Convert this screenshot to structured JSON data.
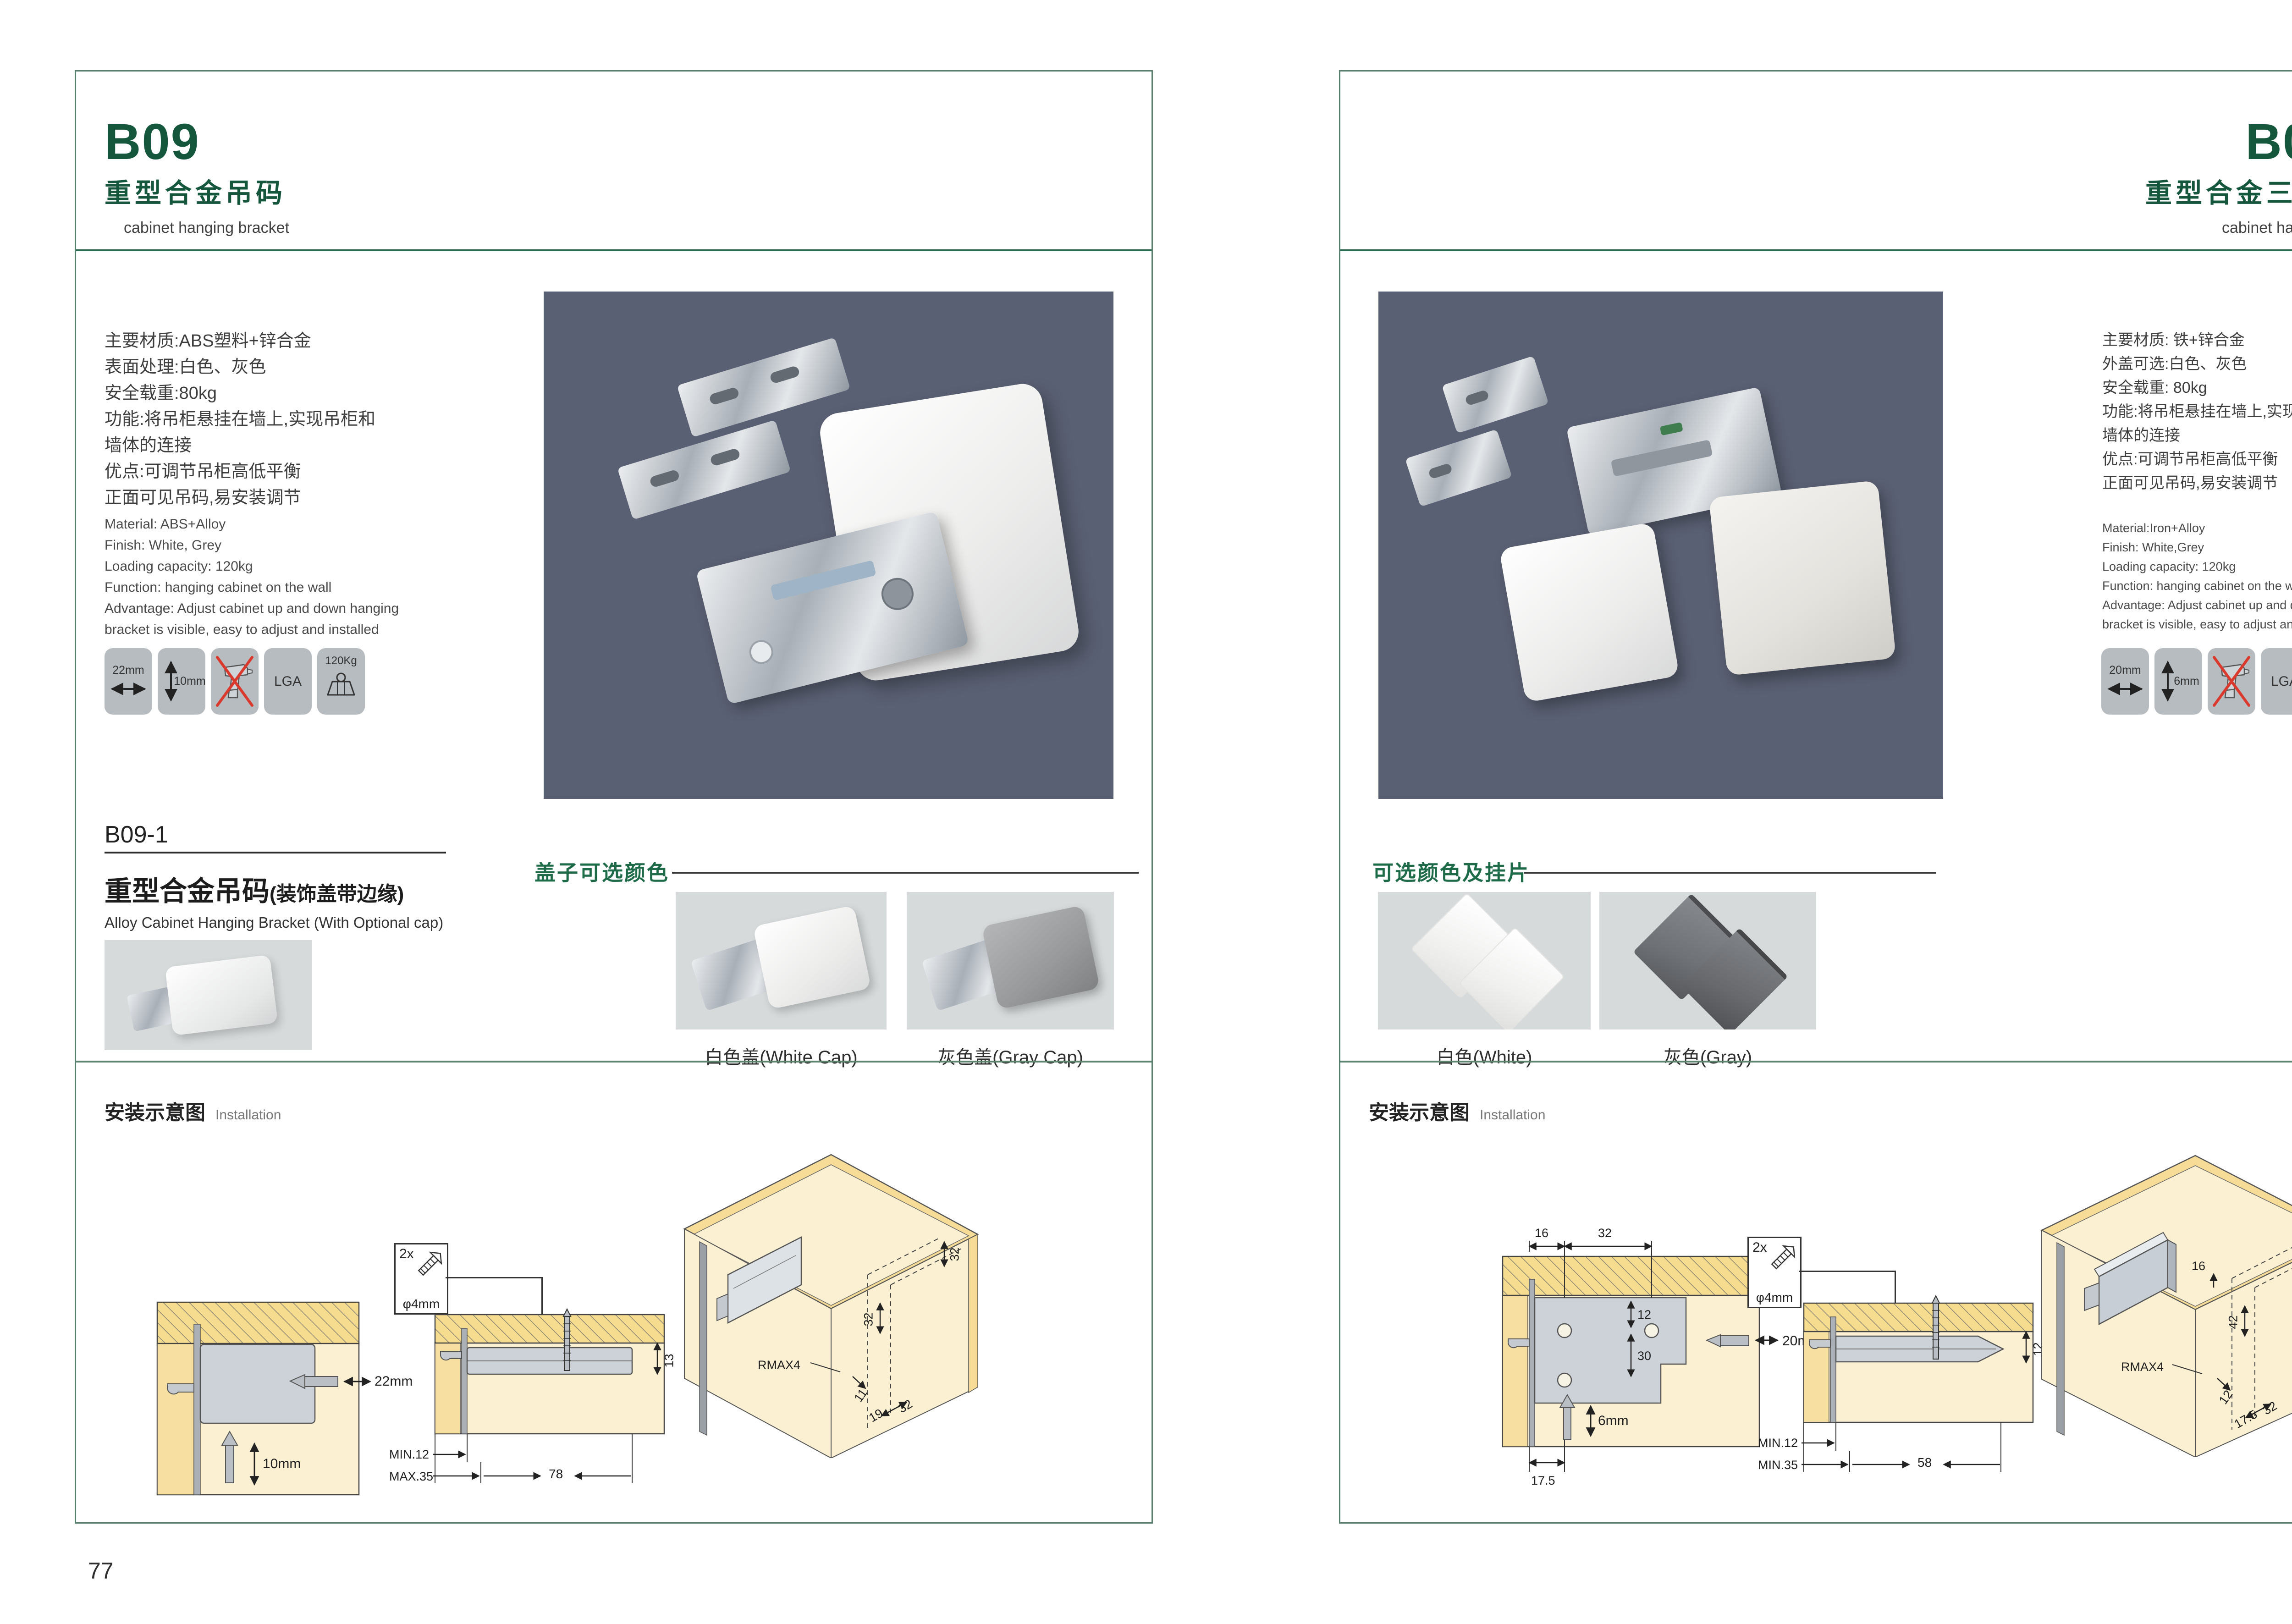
{
  "colors": {
    "accent_green": "#14573d",
    "section_green": "#1e6b49",
    "frame_green": "#577f6d",
    "photo_bg_dark": "#5a6073",
    "photo_bg_light": "#d6dadb",
    "tile_gray": "#b6bcc0",
    "diagram_yellow": "#f6dc8e",
    "diagram_cream": "#fbf0d2",
    "no_drill_red": "#da3a2e"
  },
  "left_page": {
    "code": "B09",
    "title_zh": "重型合金吊码",
    "title_en": "cabinet hanging bracket",
    "specs_zh": [
      "主要材质:ABS塑料+锌合金",
      "表面处理:白色、灰色",
      "安全载重:80kg",
      "功能:将吊柜悬挂在墙上,实现吊柜和",
      "墙体的连接",
      "优点:可调节吊柜高低平衡",
      "正面可见吊码,易安装调节"
    ],
    "specs_en": [
      "Material: ABS+Alloy",
      "Finish: White, Grey",
      "Loading capacity: 120kg",
      "Function: hanging cabinet on the wall",
      "Advantage: Adjust cabinet up and down hanging",
      "bracket is visible, easy to adjust and installed"
    ],
    "icons": {
      "width": "22mm",
      "height": "10mm",
      "cert": "LGA",
      "load": "120Kg"
    },
    "sub": {
      "code": "B09-1",
      "title_zh": "重型合金吊码",
      "title_note": "(装饰盖带边缘)",
      "title_en": "Alloy Cabinet Hanging Bracket (With Optional cap)"
    },
    "caps": {
      "heading": "盖子可选颜色",
      "labels": [
        "白色盖(White Cap)",
        "灰色盖(Gray Cap)"
      ]
    },
    "install": {
      "heading_zh": "安装示意图",
      "heading_en": "Installation",
      "screw_count": "2x",
      "screw_dia": "φ4mm",
      "d1": {
        "width": "22mm",
        "depth": "10mm"
      },
      "d2": {
        "thickness": "13",
        "min": "MIN.12",
        "max": "MAX.35",
        "length": "78"
      },
      "d3": {
        "offset_top": "32",
        "offset_mid": "32",
        "radius": "RMAX4",
        "a": "11",
        "b": "19",
        "c": "32"
      }
    },
    "page_no": "77"
  },
  "right_page": {
    "code": "B09-3",
    "title_zh": "重型合金三孔吊码",
    "title_en": "cabinet hanging bracket",
    "specs_zh": [
      "主要材质: 铁+锌合金",
      "外盖可选:白色、灰色",
      "安全载重: 80kg",
      "功能:将吊柜悬挂在墙上,实现吊柜和",
      "墙体的连接",
      "优点:可调节吊柜高低平衡",
      "正面可见吊码,易安装调节"
    ],
    "specs_en": [
      "Material:Iron+Alloy",
      "Finish: White,Grey",
      "Loading capacity: 120kg",
      "Function: hanging cabinet on the wall",
      "Advantage: Adjust cabinet up and down hanging",
      "bracket is visible, easy to adjust and installed"
    ],
    "icons": {
      "width": "20mm",
      "height": "6mm",
      "cert": "LGA",
      "load": "120Kg"
    },
    "caps": {
      "heading": "可选颜色及挂片",
      "labels": [
        "白色(White)",
        "灰色(Gray)"
      ]
    },
    "install": {
      "heading_zh": "安装示意图",
      "heading_en": "Installation",
      "screw_count": "2x",
      "screw_dia": "φ4mm",
      "d1": {
        "a": "16",
        "b": "32",
        "c": "12",
        "d": "30",
        "e": "20mm",
        "f": "6mm",
        "g": "17.5"
      },
      "d2": {
        "thickness": "12",
        "min": "MIN.12",
        "max": "MIN.35",
        "length": "58"
      },
      "d3": {
        "a": "16",
        "b": "12",
        "c": "42",
        "radius": "RMAX4",
        "d": "12",
        "e": "17.5",
        "f": "32"
      }
    },
    "page_no": "78"
  }
}
